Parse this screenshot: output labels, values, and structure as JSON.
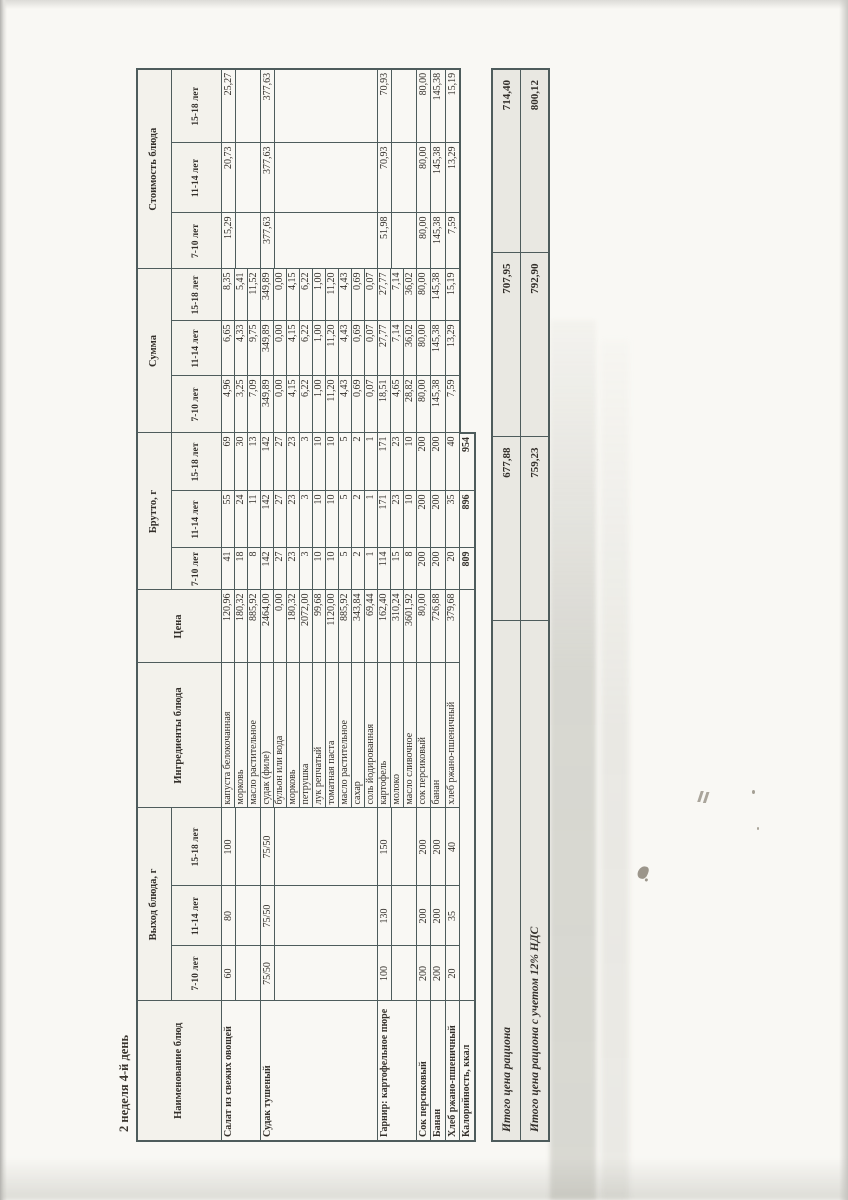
{
  "page": {
    "title": "2 неделя 4-й день"
  },
  "colors": {
    "paper": "#f9f8f4",
    "line": "#4e5c5c",
    "ink": "#332f2a",
    "totals_bg": "#e9e8e2"
  },
  "table": {
    "headers": {
      "name": "Наименование блюд",
      "yield": "Выход блюда, г",
      "ingredients": "Ингредиенты блюда",
      "price": "Цена",
      "gross": "Брутто, г",
      "sum": "Сумма",
      "cost": "Стоимость блюда",
      "age_groups": [
        "7-10 лет",
        "11-14 лет",
        "15-18 лет"
      ]
    },
    "dishes": [
      {
        "name": "Салат из свежих овощей",
        "yield": [
          "60",
          "80",
          "100"
        ],
        "cost": [
          "15,29",
          "20,73",
          "25,27"
        ],
        "ingredients": [
          {
            "name": "капуста белокочанная",
            "price": "120,96",
            "gross": [
              "41",
              "55",
              "69"
            ],
            "sum": [
              "4,96",
              "6,65",
              "8,35"
            ]
          },
          {
            "name": "морковь",
            "price": "180,32",
            "gross": [
              "18",
              "24",
              "30"
            ],
            "sum": [
              "3,25",
              "4,33",
              "5,41"
            ]
          },
          {
            "name": "масло растительное",
            "price": "885,92",
            "gross": [
              "8",
              "11",
              "13"
            ],
            "sum": [
              "7,09",
              "9,75",
              "11,52"
            ]
          }
        ]
      },
      {
        "name": "Судак тушеный",
        "yield": [
          "75/50",
          "75/50",
          "75/50"
        ],
        "cost": [
          "377,63",
          "377,63",
          "377,63"
        ],
        "ingredients": [
          {
            "name": "судак (филе)",
            "price": "2464,00",
            "gross": [
              "142",
              "142",
              "142"
            ],
            "sum": [
              "349,89",
              "349,89",
              "349,89"
            ]
          },
          {
            "name": "бульон или вода",
            "price": "0,00",
            "gross": [
              "27",
              "27",
              "27"
            ],
            "sum": [
              "0,00",
              "0,00",
              "0,00"
            ]
          },
          {
            "name": "морковь",
            "price": "180,32",
            "gross": [
              "23",
              "23",
              "23"
            ],
            "sum": [
              "4,15",
              "4,15",
              "4,15"
            ]
          },
          {
            "name": "петрушка",
            "price": "2072,00",
            "gross": [
              "3",
              "3",
              "3"
            ],
            "sum": [
              "6,22",
              "6,22",
              "6,22"
            ]
          },
          {
            "name": "лук репчатый",
            "price": "99,68",
            "gross": [
              "10",
              "10",
              "10"
            ],
            "sum": [
              "1,00",
              "1,00",
              "1,00"
            ]
          },
          {
            "name": "томатная паста",
            "price": "1120,00",
            "gross": [
              "10",
              "10",
              "10"
            ],
            "sum": [
              "11,20",
              "11,20",
              "11,20"
            ]
          },
          {
            "name": "масло растительное",
            "price": "885,92",
            "gross": [
              "5",
              "5",
              "5"
            ],
            "sum": [
              "4,43",
              "4,43",
              "4,43"
            ]
          },
          {
            "name": "сахар",
            "price": "343,84",
            "gross": [
              "2",
              "2",
              "2"
            ],
            "sum": [
              "0,69",
              "0,69",
              "0,69"
            ]
          },
          {
            "name": "соль йодированная",
            "price": "69,44",
            "gross": [
              "1",
              "1",
              "1"
            ],
            "sum": [
              "0,07",
              "0,07",
              "0,07"
            ]
          }
        ]
      },
      {
        "name": "Гарнир: картофельное пюре",
        "yield": [
          "100",
          "130",
          "150"
        ],
        "cost": [
          "51,98",
          "70,93",
          "70,93"
        ],
        "ingredients": [
          {
            "name": "картофель",
            "price": "162,40",
            "gross": [
              "114",
              "171",
              "171"
            ],
            "sum": [
              "18,51",
              "27,77",
              "27,77"
            ]
          },
          {
            "name": "молоко",
            "price": "310,24",
            "gross": [
              "15",
              "23",
              "23"
            ],
            "sum": [
              "4,65",
              "7,14",
              "7,14"
            ]
          },
          {
            "name": "масло сливочное",
            "price": "3601,92",
            "gross": [
              "8",
              "10",
              "10"
            ],
            "sum": [
              "28,82",
              "36,02",
              "36,02"
            ]
          }
        ]
      },
      {
        "name": "Сок персиковый",
        "yield": [
          "200",
          "200",
          "200"
        ],
        "cost": [
          "80,00",
          "80,00",
          "80,00"
        ],
        "ingredients": [
          {
            "name": "сок персиковый",
            "price": "80,00",
            "gross": [
              "200",
              "200",
              "200"
            ],
            "sum": [
              "80,00",
              "80,00",
              "80,00"
            ]
          }
        ]
      },
      {
        "name": "Банан",
        "yield": [
          "200",
          "200",
          "200"
        ],
        "cost": [
          "145,38",
          "145,38",
          "145,38"
        ],
        "ingredients": [
          {
            "name": "банан",
            "price": "726,88",
            "gross": [
              "200",
              "200",
              "200"
            ],
            "sum": [
              "145,38",
              "145,38",
              "145,38"
            ]
          }
        ]
      },
      {
        "name": "Хлеб ржано-пшеничный",
        "yield": [
          "20",
          "35",
          "40"
        ],
        "cost": [
          "7,59",
          "13,29",
          "15,19"
        ],
        "ingredients": [
          {
            "name": "хлеб ржано-пшеничный",
            "price": "379,68",
            "gross": [
              "20",
              "35",
              "40"
            ],
            "sum": [
              "7,59",
              "13,29",
              "15,19"
            ]
          }
        ]
      }
    ],
    "calories_row": {
      "label": "Калорийность, ккал",
      "gross_totals": [
        "809",
        "896",
        "954"
      ]
    }
  },
  "footer": {
    "rows": [
      {
        "label": "Итого цена рациона",
        "values": [
          "677,88",
          "707,95",
          "714,40"
        ]
      },
      {
        "label": "Итого цена рациона с учетом 12% НДС",
        "values": [
          "759,23",
          "792,90",
          "800,12"
        ]
      }
    ]
  }
}
